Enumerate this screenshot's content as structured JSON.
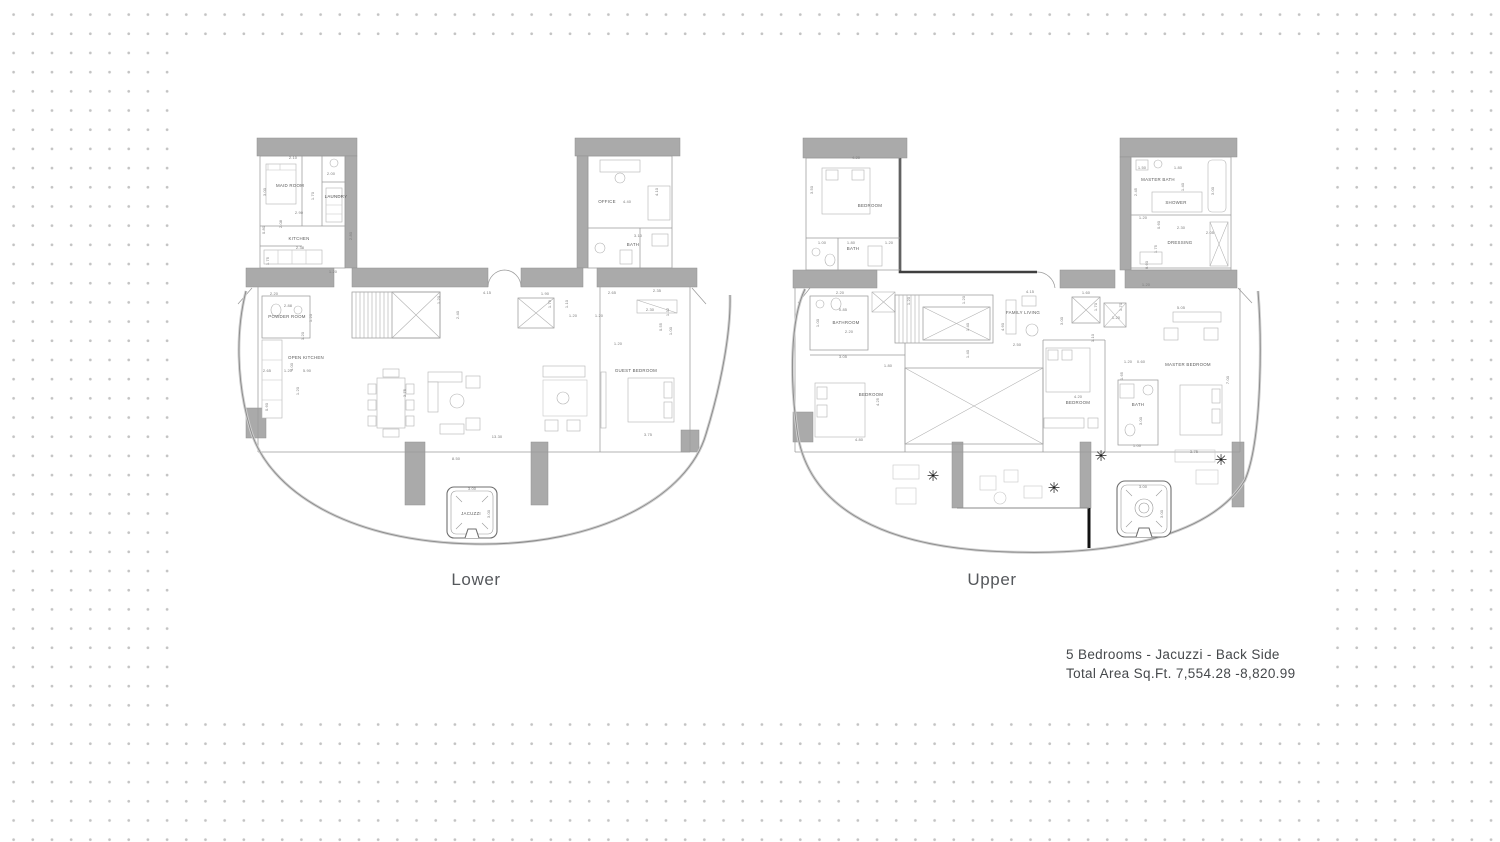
{
  "plan_labels": {
    "lower": "Lower",
    "upper": "Upper"
  },
  "caption": {
    "line1": "5 Bedrooms - Jacuzzi - Back Side",
    "line2": "Total Area Sq.Ft.  7,554.28  -8,820.99"
  },
  "colors": {
    "wall_fill": "#aaaaaa",
    "line": "#9b9b9b",
    "dark_wall": "#3f3f3f",
    "accent_black": "#121212",
    "dot": "#c3c3c3",
    "dim_text": "#7c7c7c",
    "room_text": "#5a5a5a"
  },
  "plants": {
    "glyph": "✳",
    "positions": [
      [
        933,
        481
      ],
      [
        1054,
        493
      ],
      [
        1101,
        461
      ],
      [
        1221,
        465
      ]
    ]
  },
  "plans": {
    "lower": {
      "rooms": [
        {
          "t": "MAID ROOM",
          "x": 290,
          "y": 187
        },
        {
          "t": "LAUNDRY",
          "x": 336,
          "y": 198
        },
        {
          "t": "KITCHEN",
          "x": 299,
          "y": 240
        },
        {
          "t": "OFFICE",
          "x": 607,
          "y": 203
        },
        {
          "t": "BATH",
          "x": 633,
          "y": 246
        },
        {
          "t": "POWDER ROOM",
          "x": 287,
          "y": 318
        },
        {
          "t": "OPEN KITCHEN",
          "x": 306,
          "y": 359
        },
        {
          "t": "GUEST BEDROOM",
          "x": 636,
          "y": 372
        },
        {
          "t": "JACUZZI",
          "x": 471,
          "y": 515
        }
      ],
      "dims": [
        {
          "t": "2.10",
          "x": 293,
          "y": 159
        },
        {
          "t": "2.00",
          "x": 331,
          "y": 175
        },
        {
          "t": "3.00",
          "x": 266,
          "y": 192,
          "r": 1
        },
        {
          "t": "1.70",
          "x": 314,
          "y": 196,
          "r": 1
        },
        {
          "t": "2.90",
          "x": 299,
          "y": 214
        },
        {
          "t": "0.80",
          "x": 265,
          "y": 230,
          "r": 1
        },
        {
          "t": "2.08",
          "x": 282,
          "y": 224,
          "r": 1
        },
        {
          "t": "1.75",
          "x": 269,
          "y": 261,
          "r": 1
        },
        {
          "t": "2.38",
          "x": 300,
          "y": 249
        },
        {
          "t": "2.80",
          "x": 352,
          "y": 236,
          "r": 1
        },
        {
          "t": "1.20",
          "x": 333,
          "y": 273
        },
        {
          "t": "4.40",
          "x": 627,
          "y": 203
        },
        {
          "t": "4.10",
          "x": 658,
          "y": 192,
          "r": 1
        },
        {
          "t": "3.10",
          "x": 638,
          "y": 237
        },
        {
          "t": "4.15",
          "x": 487,
          "y": 294
        },
        {
          "t": "1.90",
          "x": 545,
          "y": 295
        },
        {
          "t": "2.65",
          "x": 612,
          "y": 294
        },
        {
          "t": "1.20",
          "x": 440,
          "y": 300,
          "r": 1
        },
        {
          "t": "2.40",
          "x": 459,
          "y": 315,
          "r": 1
        },
        {
          "t": "1.79",
          "x": 551,
          "y": 304,
          "r": 1
        },
        {
          "t": "1.10",
          "x": 568,
          "y": 304,
          "r": 1
        },
        {
          "t": "1.20",
          "x": 573,
          "y": 317
        },
        {
          "t": "1.20",
          "x": 599,
          "y": 317
        },
        {
          "t": "2.20",
          "x": 274,
          "y": 295
        },
        {
          "t": "2.88",
          "x": 288,
          "y": 307
        },
        {
          "t": "1.20",
          "x": 312,
          "y": 318,
          "r": 1
        },
        {
          "t": "1.20",
          "x": 304,
          "y": 336,
          "r": 1
        },
        {
          "t": "4.00",
          "x": 293,
          "y": 367,
          "r": 1
        },
        {
          "t": "2.65",
          "x": 267,
          "y": 372
        },
        {
          "t": "1.20",
          "x": 288,
          "y": 372
        },
        {
          "t": "5.90",
          "x": 307,
          "y": 372
        },
        {
          "t": "1.20",
          "x": 299,
          "y": 391,
          "r": 1
        },
        {
          "t": "0.60",
          "x": 268,
          "y": 407,
          "r": 1
        },
        {
          "t": "3.75",
          "x": 406,
          "y": 393,
          "r": 1
        },
        {
          "t": "13.30",
          "x": 497,
          "y": 438
        },
        {
          "t": "3.75",
          "x": 648,
          "y": 436
        },
        {
          "t": "2.35",
          "x": 657,
          "y": 292
        },
        {
          "t": "2.30",
          "x": 650,
          "y": 311
        },
        {
          "t": "1.32",
          "x": 669,
          "y": 312,
          "r": 1
        },
        {
          "t": "0.55",
          "x": 662,
          "y": 327,
          "r": 1
        },
        {
          "t": "1.00",
          "x": 672,
          "y": 331,
          "r": 1
        },
        {
          "t": "1.20",
          "x": 618,
          "y": 345
        },
        {
          "t": "8.50",
          "x": 456,
          "y": 460
        },
        {
          "t": "3.00",
          "x": 472,
          "y": 490
        },
        {
          "t": "3.00",
          "x": 490,
          "y": 514,
          "r": 1
        }
      ]
    },
    "upper": {
      "rooms": [
        {
          "t": "BEDROOM",
          "x": 870,
          "y": 207
        },
        {
          "t": "BATH",
          "x": 853,
          "y": 250
        },
        {
          "t": "MASTER BATH",
          "x": 1158,
          "y": 181
        },
        {
          "t": "SHOWER",
          "x": 1176,
          "y": 204
        },
        {
          "t": "DRESSING",
          "x": 1180,
          "y": 244
        },
        {
          "t": "BATHROOM",
          "x": 846,
          "y": 324
        },
        {
          "t": "FAMILY LIVING",
          "x": 1023,
          "y": 314
        },
        {
          "t": "BEDROOM",
          "x": 871,
          "y": 396
        },
        {
          "t": "BEDROOM",
          "x": 1078,
          "y": 404
        },
        {
          "t": "BATH",
          "x": 1138,
          "y": 406
        },
        {
          "t": "MASTER BEDROOM",
          "x": 1188,
          "y": 366
        }
      ],
      "dims": [
        {
          "t": "4.20",
          "x": 856,
          "y": 159
        },
        {
          "t": "3.50",
          "x": 813,
          "y": 190,
          "r": 1
        },
        {
          "t": "1.00",
          "x": 822,
          "y": 244
        },
        {
          "t": "1.80",
          "x": 851,
          "y": 244
        },
        {
          "t": "1.20",
          "x": 889,
          "y": 244
        },
        {
          "t": "1.50",
          "x": 1142,
          "y": 169
        },
        {
          "t": "1.80",
          "x": 1178,
          "y": 169
        },
        {
          "t": "2.45",
          "x": 1137,
          "y": 192,
          "r": 1
        },
        {
          "t": "1.40",
          "x": 1184,
          "y": 187,
          "r": 1
        },
        {
          "t": "3.00",
          "x": 1214,
          "y": 191,
          "r": 1
        },
        {
          "t": "1.20",
          "x": 1143,
          "y": 219
        },
        {
          "t": "0.60",
          "x": 1160,
          "y": 225,
          "r": 1
        },
        {
          "t": "2.30",
          "x": 1181,
          "y": 229
        },
        {
          "t": "2.05",
          "x": 1210,
          "y": 234
        },
        {
          "t": "1.75",
          "x": 1157,
          "y": 249,
          "r": 1
        },
        {
          "t": "0.60",
          "x": 1148,
          "y": 265,
          "r": 1
        },
        {
          "t": "1.20",
          "x": 1146,
          "y": 286
        },
        {
          "t": "2.20",
          "x": 840,
          "y": 294
        },
        {
          "t": "0.85",
          "x": 843,
          "y": 311
        },
        {
          "t": "1.00",
          "x": 819,
          "y": 323,
          "r": 1
        },
        {
          "t": "2.20",
          "x": 849,
          "y": 333
        },
        {
          "t": "3.05",
          "x": 843,
          "y": 358
        },
        {
          "t": "1.80",
          "x": 888,
          "y": 367
        },
        {
          "t": "4.25",
          "x": 879,
          "y": 402,
          "r": 1
        },
        {
          "t": "4.80",
          "x": 859,
          "y": 441
        },
        {
          "t": "1.20",
          "x": 910,
          "y": 301,
          "r": 1
        },
        {
          "t": "1.20",
          "x": 965,
          "y": 300,
          "r": 1
        },
        {
          "t": "1.40",
          "x": 969,
          "y": 327,
          "r": 1
        },
        {
          "t": "1.40",
          "x": 969,
          "y": 354,
          "r": 1
        },
        {
          "t": "4.60",
          "x": 1004,
          "y": 327,
          "r": 1
        },
        {
          "t": "4.15",
          "x": 1030,
          "y": 293
        },
        {
          "t": "2.50",
          "x": 1017,
          "y": 346
        },
        {
          "t": "1.60",
          "x": 1086,
          "y": 294
        },
        {
          "t": "1.70",
          "x": 1097,
          "y": 307,
          "r": 1
        },
        {
          "t": "1.70",
          "x": 1122,
          "y": 307,
          "r": 1
        },
        {
          "t": "3.00",
          "x": 1063,
          "y": 321,
          "r": 1
        },
        {
          "t": "1.10",
          "x": 1094,
          "y": 338,
          "r": 1
        },
        {
          "t": "1.20",
          "x": 1116,
          "y": 319
        },
        {
          "t": "5.05",
          "x": 1181,
          "y": 309
        },
        {
          "t": "7.00",
          "x": 1229,
          "y": 380,
          "r": 1
        },
        {
          "t": "1.20",
          "x": 1128,
          "y": 363
        },
        {
          "t": "0.60",
          "x": 1141,
          "y": 363
        },
        {
          "t": "1.65",
          "x": 1123,
          "y": 376,
          "r": 1
        },
        {
          "t": "4.20",
          "x": 1078,
          "y": 398
        },
        {
          "t": "3.00",
          "x": 1142,
          "y": 421,
          "r": 1
        },
        {
          "t": "1.00",
          "x": 1137,
          "y": 447
        },
        {
          "t": "3.75",
          "x": 1194,
          "y": 453
        },
        {
          "t": "3.00",
          "x": 1143,
          "y": 488
        },
        {
          "t": "3.00",
          "x": 1163,
          "y": 514,
          "r": 1
        }
      ]
    }
  }
}
